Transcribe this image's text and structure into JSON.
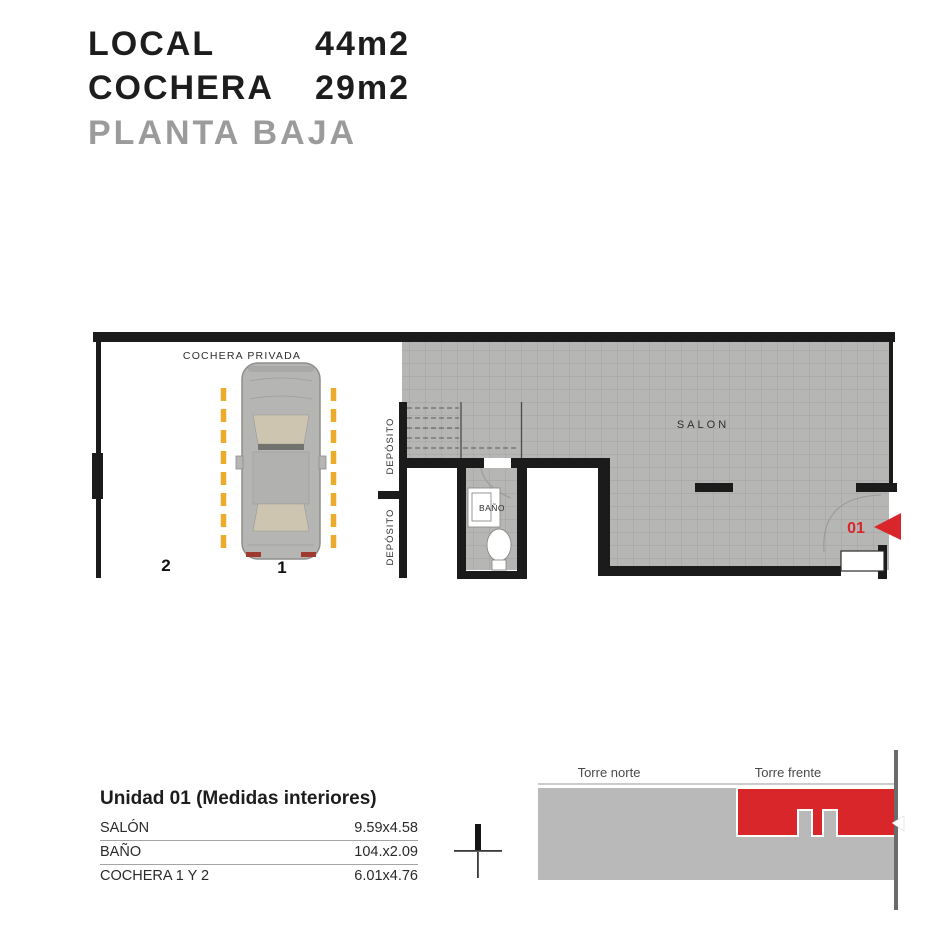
{
  "title_block": {
    "local_label": "LOCAL",
    "local_area": "44m2",
    "cochera_label": "COCHERA",
    "cochera_area": "29m2",
    "floor_label": "PLANTA BAJA"
  },
  "floor_plan": {
    "cochera_privada_label": "COCHERA PRIVADA",
    "salon_label": "SALON",
    "bano_label": "BAÑO",
    "deposito_label_top": "DEPÓSITO",
    "deposito_label_bottom": "DEPÓSITO",
    "parking_spot_left": "2",
    "parking_spot_right": "1",
    "unit_marker": "01"
  },
  "measures_table": {
    "title": "Unidad 01 (Medidas interiores)",
    "rows": [
      {
        "label": "SALÓN",
        "value": "9.59x4.58"
      },
      {
        "label": "BAÑO",
        "value": "104.x2.09"
      },
      {
        "label": "COCHERA 1 Y 2",
        "value": "6.01x4.76"
      }
    ]
  },
  "compass": {
    "north_label": "N"
  },
  "site_plan": {
    "tower_left_label": "Torre norte",
    "tower_right_label": "Torre frente"
  },
  "colors": {
    "accent_red": "#d9262b",
    "parking_yellow": "#ecab2b",
    "wall_black": "#1b1b1b",
    "floor_hatch_gray": "#b6b6b4",
    "hatch_grid_line": "#a2a2a0",
    "subtitle_gray": "#9b9b9b",
    "site_building_gray": "#b9b9b9"
  }
}
